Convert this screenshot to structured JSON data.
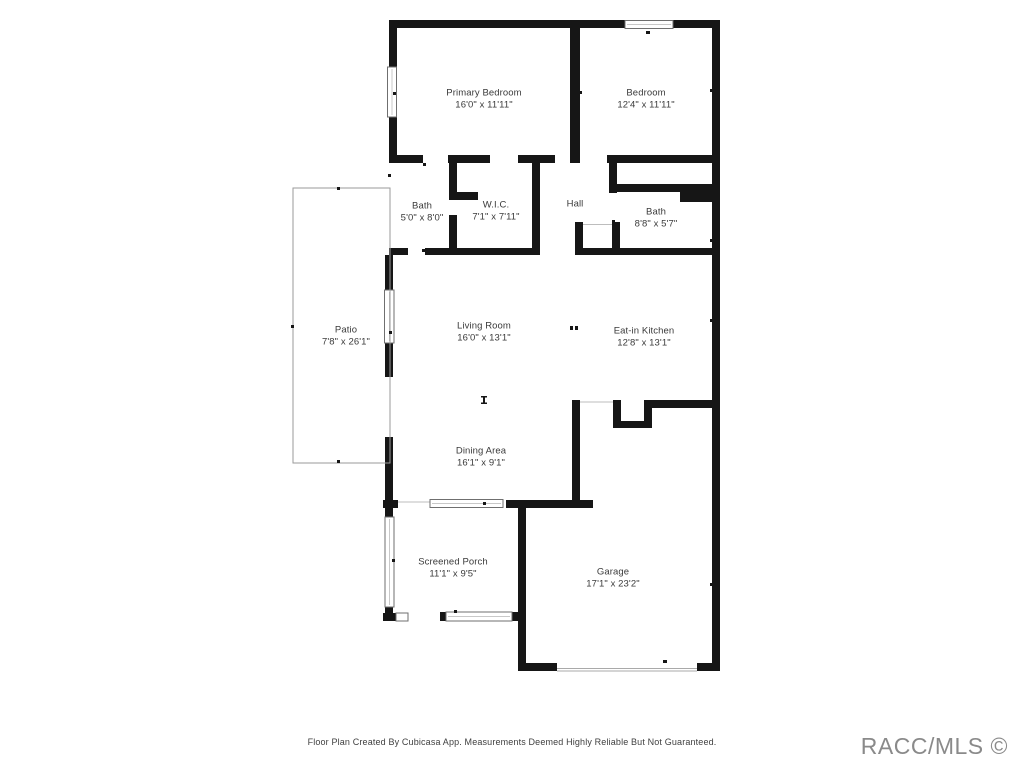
{
  "floor_plan": {
    "title": "CubiCasa residential floor plan",
    "rooms": [
      {
        "id": "primary-bedroom",
        "name": "Primary Bedroom",
        "dims": "16'0\" x 11'11\""
      },
      {
        "id": "bedroom",
        "name": "Bedroom",
        "dims": "12'4\" x 11'11\""
      },
      {
        "id": "bath-1",
        "name": "Bath",
        "dims": "5'0\" x 8'0\""
      },
      {
        "id": "wic",
        "name": "W.I.C.",
        "dims": "7'1\" x 7'11\""
      },
      {
        "id": "hall",
        "name": "Hall",
        "dims": ""
      },
      {
        "id": "bath-2",
        "name": "Bath",
        "dims": "8'8\" x 5'7\""
      },
      {
        "id": "patio",
        "name": "Patio",
        "dims": "7'8\" x 26'1\""
      },
      {
        "id": "living-room",
        "name": "Living Room",
        "dims": "16'0\" x 13'1\""
      },
      {
        "id": "eat-in-kitchen",
        "name": "Eat-in Kitchen",
        "dims": "12'8\" x 13'1\""
      },
      {
        "id": "dining-area",
        "name": "Dining Area",
        "dims": "16'1\" x 9'1\""
      },
      {
        "id": "screened-porch",
        "name": "Screened Porch",
        "dims": "11'1\" x 9'5\""
      },
      {
        "id": "garage",
        "name": "Garage",
        "dims": "17'1\" x 23'2\""
      }
    ],
    "colors": {
      "wall": "#161616",
      "window_frame": "#6f6f6f",
      "patio_outline": "#9a9a9a",
      "label_text": "#3a3a3a",
      "watermark_text": "#8a8a8a"
    }
  },
  "footer": {
    "disclaimer": "Floor Plan Created By Cubicasa App. Measurements Deemed Highly Reliable But Not Guaranteed."
  },
  "watermark": {
    "text": "RACC/MLS ©"
  }
}
